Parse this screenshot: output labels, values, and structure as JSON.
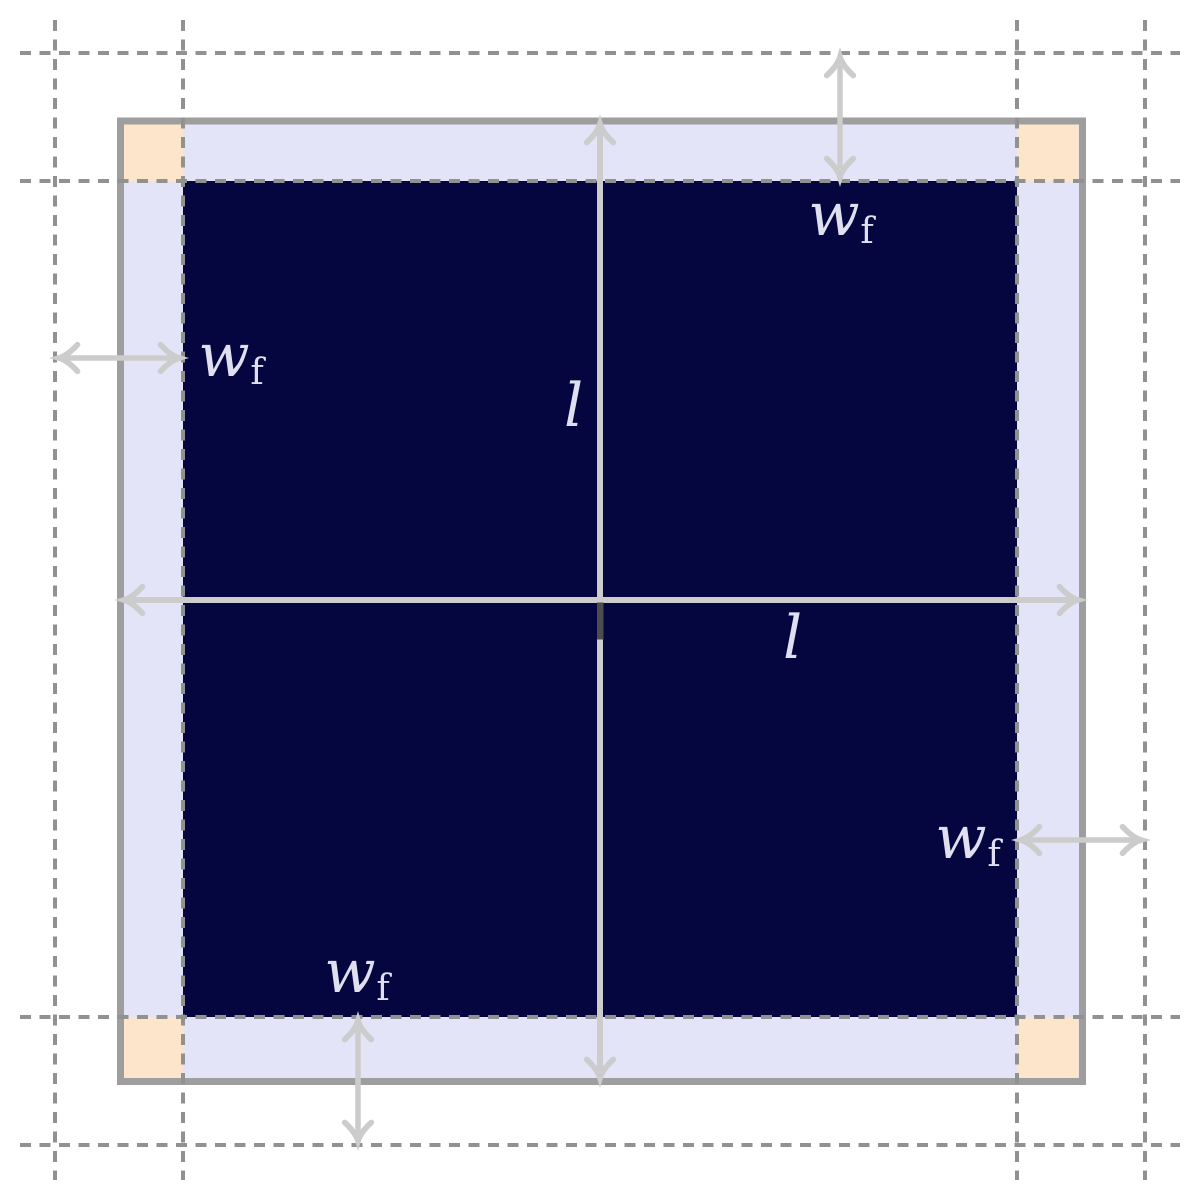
{
  "labels": {
    "wf_top": {
      "main": "w",
      "sub": "f"
    },
    "wf_left": {
      "main": "w",
      "sub": "f"
    },
    "wf_right": {
      "main": "w",
      "sub": "f"
    },
    "wf_bottom": {
      "main": "w",
      "sub": "f"
    },
    "l_vertical": {
      "main": "l",
      "sub": ""
    },
    "l_horizontal": {
      "main": "l",
      "sub": ""
    }
  },
  "colors": {
    "background": "#ffffff",
    "membrane_navy": "#05053f",
    "frame_lavender": "#e4e4f8",
    "corner_peach": "#fde5cb",
    "border_gray": "#9e9e9e",
    "dash_gray": "#919191",
    "arrow_gray": "#cccccc",
    "marker_dark": "#4d4d4d",
    "label_color": "#dfdfef"
  }
}
